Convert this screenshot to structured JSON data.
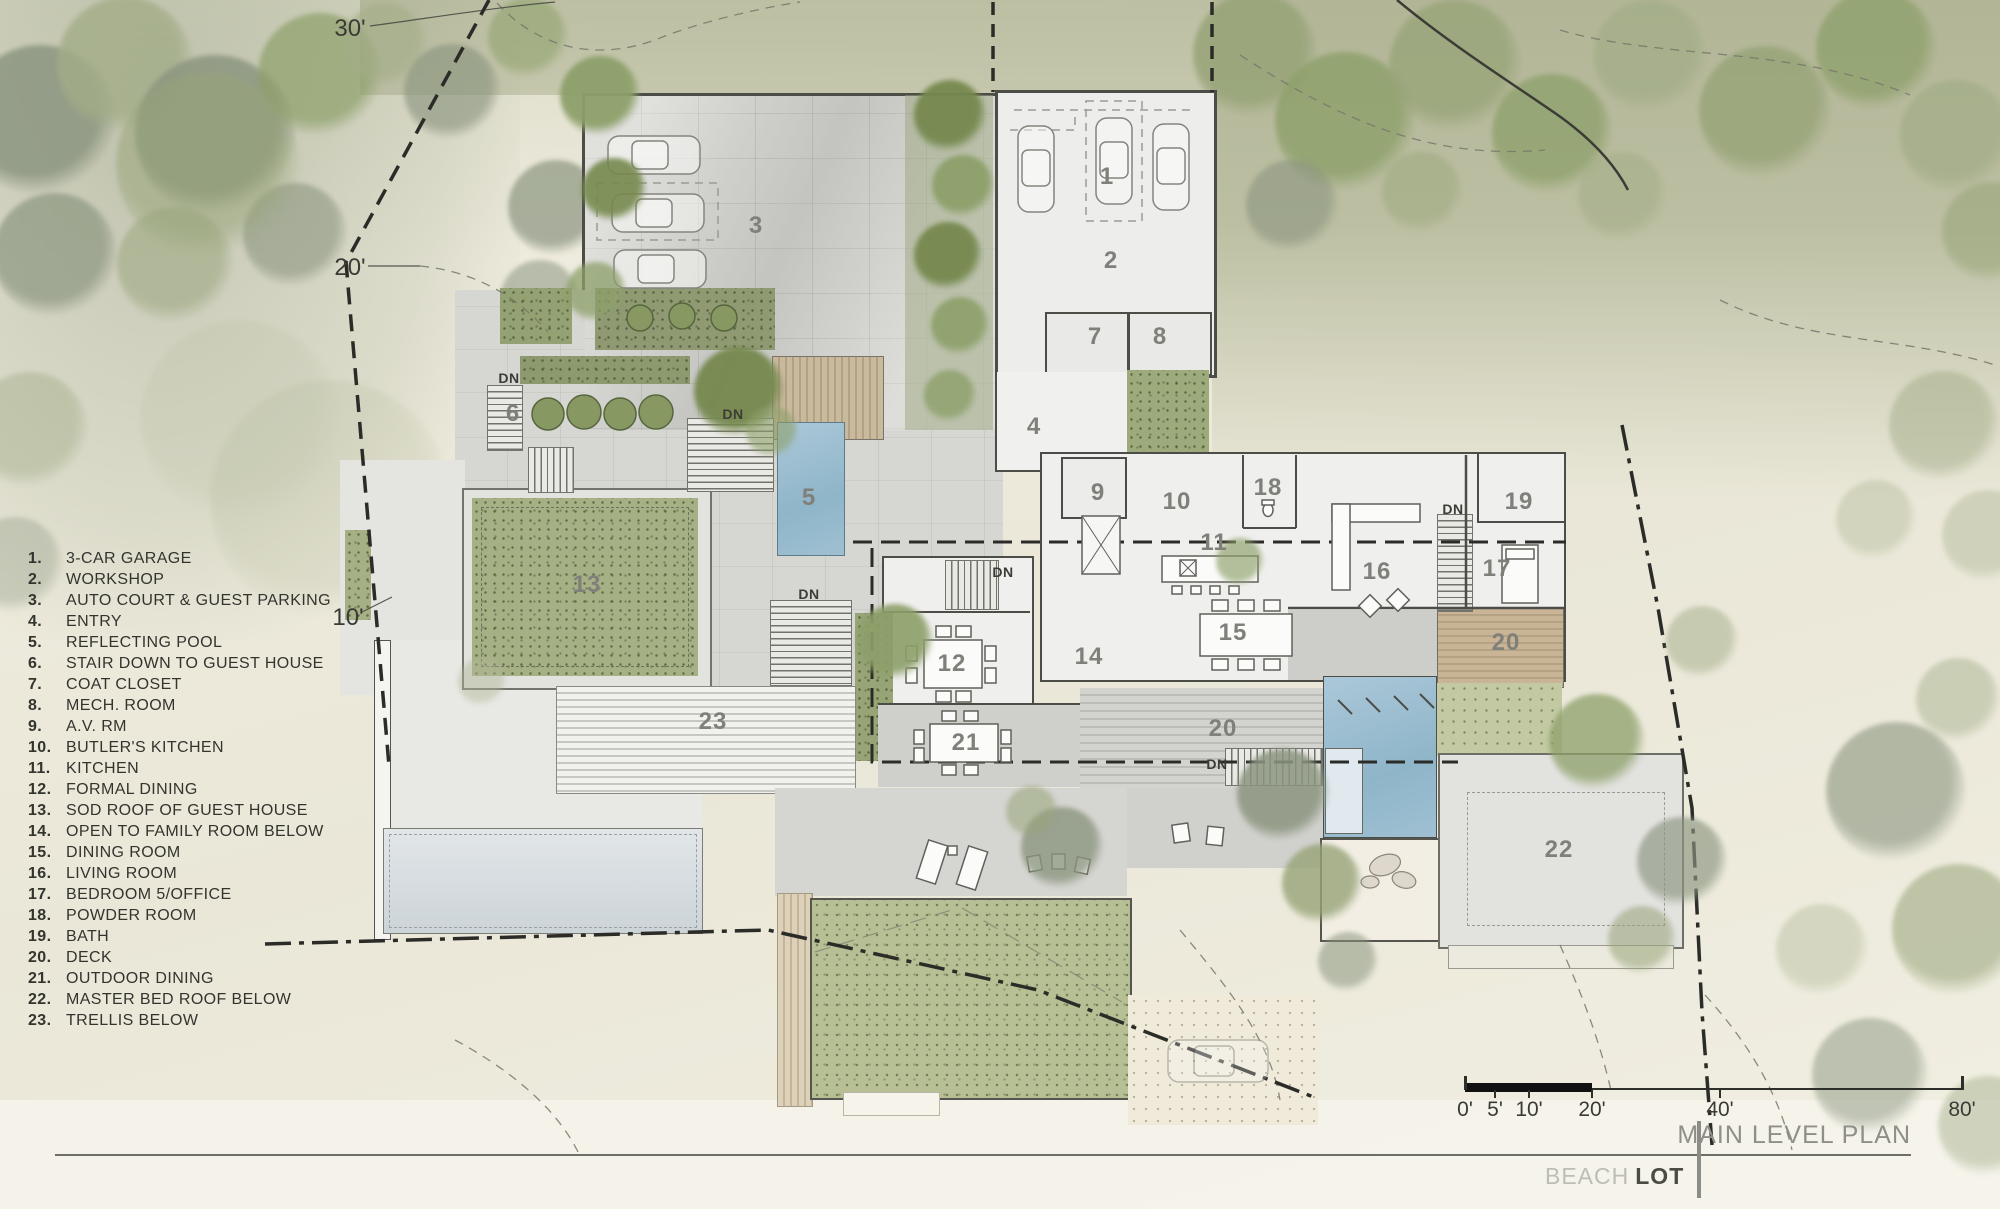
{
  "title_block": {
    "sheet_title": "MAIN LEVEL PLAN",
    "project_light": "BEACH",
    "project_bold": "LOT"
  },
  "legend": {
    "items": [
      {
        "num": "1.",
        "label": "3-CAR GARAGE"
      },
      {
        "num": "2.",
        "label": "WORKSHOP"
      },
      {
        "num": "3.",
        "label": "AUTO COURT & GUEST PARKING"
      },
      {
        "num": "4.",
        "label": "ENTRY"
      },
      {
        "num": "5.",
        "label": "REFLECTING POOL"
      },
      {
        "num": "6.",
        "label": "STAIR DOWN TO GUEST HOUSE"
      },
      {
        "num": "7.",
        "label": "COAT CLOSET"
      },
      {
        "num": "8.",
        "label": "MECH. ROOM"
      },
      {
        "num": "9.",
        "label": "A.V. RM"
      },
      {
        "num": "10.",
        "label": "BUTLER'S KITCHEN"
      },
      {
        "num": "11.",
        "label": "KITCHEN"
      },
      {
        "num": "12.",
        "label": "FORMAL DINING"
      },
      {
        "num": "13.",
        "label": "SOD ROOF OF GUEST HOUSE"
      },
      {
        "num": "14.",
        "label": "OPEN TO FAMILY ROOM BELOW"
      },
      {
        "num": "15.",
        "label": "DINING ROOM"
      },
      {
        "num": "16.",
        "label": "LIVING ROOM"
      },
      {
        "num": "17.",
        "label": "BEDROOM 5/OFFICE"
      },
      {
        "num": "18.",
        "label": "POWDER ROOM"
      },
      {
        "num": "19.",
        "label": "BATH"
      },
      {
        "num": "20.",
        "label": "DECK"
      },
      {
        "num": "21.",
        "label": "OUTDOOR DINING"
      },
      {
        "num": "22.",
        "label": "MASTER BED ROOF BELOW"
      },
      {
        "num": "23.",
        "label": "TRELLIS BELOW"
      }
    ]
  },
  "scale_bar": {
    "ticks": [
      {
        "text": "0'",
        "x": 1465
      },
      {
        "text": "5'",
        "x": 1495
      },
      {
        "text": "10'",
        "x": 1529
      },
      {
        "text": "20'",
        "x": 1592
      },
      {
        "text": "40'",
        "x": 1720
      },
      {
        "text": "80'",
        "x": 1962
      }
    ]
  },
  "contour_labels": [
    {
      "t": "30'",
      "x": 350,
      "y": 29
    },
    {
      "t": "20'",
      "x": 350,
      "y": 268
    },
    {
      "t": "10'",
      "x": 348,
      "y": 618
    }
  ],
  "room_labels": [
    {
      "t": "1",
      "x": 1107,
      "y": 177
    },
    {
      "t": "2",
      "x": 1111,
      "y": 261
    },
    {
      "t": "3",
      "x": 756,
      "y": 226
    },
    {
      "t": "4",
      "x": 1034,
      "y": 427
    },
    {
      "t": "5",
      "x": 809,
      "y": 498
    },
    {
      "t": "6",
      "x": 513,
      "y": 414
    },
    {
      "t": "7",
      "x": 1095,
      "y": 337
    },
    {
      "t": "8",
      "x": 1160,
      "y": 337
    },
    {
      "t": "9",
      "x": 1098,
      "y": 493
    },
    {
      "t": "10",
      "x": 1177,
      "y": 502
    },
    {
      "t": "11",
      "x": 1214,
      "y": 543
    },
    {
      "t": "12",
      "x": 952,
      "y": 664
    },
    {
      "t": "13",
      "x": 587,
      "y": 585
    },
    {
      "t": "14",
      "x": 1089,
      "y": 657
    },
    {
      "t": "15",
      "x": 1233,
      "y": 633
    },
    {
      "t": "16",
      "x": 1377,
      "y": 572
    },
    {
      "t": "17",
      "x": 1497,
      "y": 569
    },
    {
      "t": "18",
      "x": 1268,
      "y": 488
    },
    {
      "t": "19",
      "x": 1519,
      "y": 502
    },
    {
      "t": "20",
      "x": 1506,
      "y": 643
    },
    {
      "t": "20",
      "x": 1223,
      "y": 729
    },
    {
      "t": "21",
      "x": 966,
      "y": 743
    },
    {
      "t": "22",
      "x": 1559,
      "y": 850
    },
    {
      "t": "23",
      "x": 713,
      "y": 722
    }
  ],
  "stair_labels": [
    {
      "t": "DN",
      "x": 509,
      "y": 378
    },
    {
      "t": "DN",
      "x": 733,
      "y": 414
    },
    {
      "t": "DN",
      "x": 809,
      "y": 594
    },
    {
      "t": "DN",
      "x": 1003,
      "y": 572
    },
    {
      "t": "DN",
      "x": 1453,
      "y": 509
    },
    {
      "t": "DN",
      "x": 1217,
      "y": 764
    }
  ]
}
